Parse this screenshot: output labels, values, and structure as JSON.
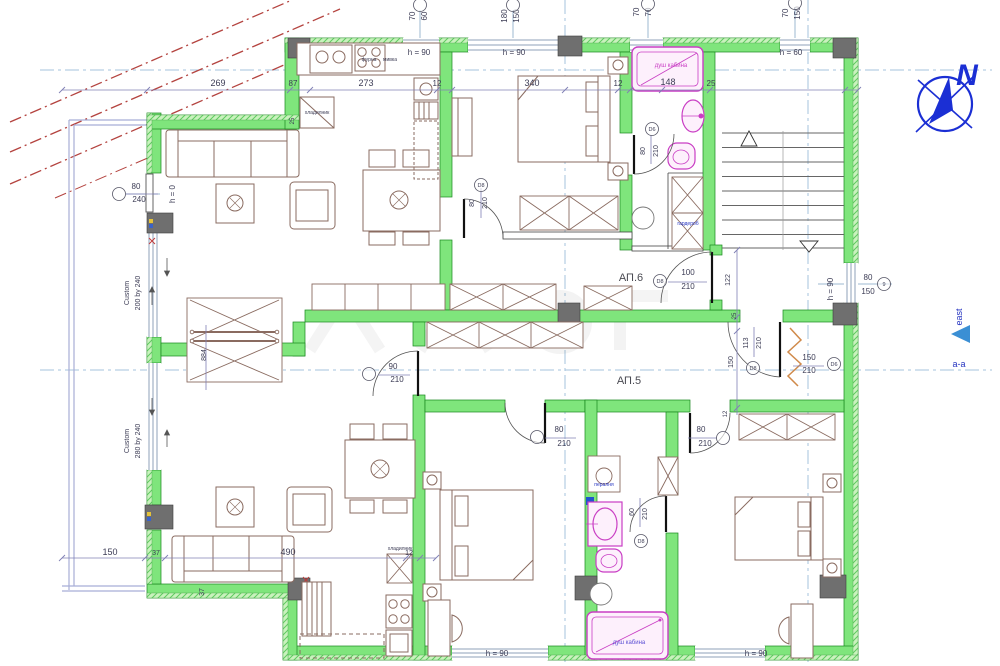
{
  "drawing": {
    "type": "architectural-floor-plan",
    "apartments": [
      {
        "id": "АП.6"
      },
      {
        "id": "АП.5"
      }
    ],
    "door_types": [
      "D6",
      "D8"
    ],
    "compass": {
      "north_letter": "N",
      "east_label": "east",
      "section_label": "а-а"
    },
    "colors": {
      "dim": "#3c3c55",
      "dim2": "#4a4a52",
      "blue": "#2433c0",
      "navy": "#1b2fd4",
      "pink": "#c93ec4",
      "violet": "#5b4fd4",
      "wall": "#7fe57c",
      "wallEdge": "#18871d",
      "column": "#6f6f6f",
      "furniture": "#8a6b60",
      "redline": "#b4433f",
      "axis": "#a6c3dc",
      "dimline": "#8080b5",
      "balcony": "#a8aed6",
      "orange": "#d08a4a",
      "eastTriangle": "#3b8fd4"
    },
    "labels": [
      {
        "t": "70",
        "x": 415,
        "y": 16,
        "r": -90,
        "s": 8
      },
      {
        "t": "60",
        "x": 427,
        "y": 16,
        "r": -90,
        "s": 8
      },
      {
        "t": "180",
        "x": 507,
        "y": 16,
        "r": -90,
        "s": 8
      },
      {
        "t": "150",
        "x": 519,
        "y": 16,
        "r": -90,
        "s": 8
      },
      {
        "t": "70",
        "x": 639,
        "y": 12,
        "r": -90,
        "s": 8
      },
      {
        "t": "70",
        "x": 651,
        "y": 12,
        "r": -90,
        "s": 8
      },
      {
        "t": "70",
        "x": 788,
        "y": 13,
        "r": -90,
        "s": 8
      },
      {
        "t": "150",
        "x": 800,
        "y": 13,
        "r": -90,
        "s": 8
      },
      {
        "t": "269",
        "x": 218,
        "y": 86,
        "s": 9
      },
      {
        "t": "87",
        "x": 293,
        "y": 86,
        "s": 8
      },
      {
        "t": "273",
        "x": 366,
        "y": 86,
        "s": 9
      },
      {
        "t": "12",
        "x": 437,
        "y": 86,
        "s": 8
      },
      {
        "t": "340",
        "x": 532,
        "y": 86,
        "s": 9
      },
      {
        "t": "12",
        "x": 618,
        "y": 86,
        "s": 8
      },
      {
        "t": "148",
        "x": 668,
        "y": 85,
        "s": 9
      },
      {
        "t": "25",
        "x": 711,
        "y": 86,
        "s": 8
      },
      {
        "t": "h = 90",
        "x": 419,
        "y": 55,
        "s": 8
      },
      {
        "t": "h = 90",
        "x": 514,
        "y": 55,
        "s": 8
      },
      {
        "t": "h = 60",
        "x": 791,
        "y": 55,
        "s": 8
      },
      {
        "t": "h = 90",
        "x": 497,
        "y": 656,
        "s": 8
      },
      {
        "t": "h = 90",
        "x": 756,
        "y": 656,
        "s": 8
      },
      {
        "t": "h = 0",
        "x": 175,
        "y": 194,
        "r": -90,
        "s": 8
      },
      {
        "t": "h = 90",
        "x": 833,
        "y": 289,
        "r": -90,
        "s": 8
      },
      {
        "t": "80",
        "x": 136,
        "y": 189,
        "s": 8
      },
      {
        "t": "240",
        "x": 139,
        "y": 202,
        "s": 8
      },
      {
        "t": "Custom",
        "x": 129,
        "y": 293,
        "r": -90,
        "s": 7
      },
      {
        "t": "200 by 240",
        "x": 140,
        "y": 293,
        "r": -90,
        "s": 7
      },
      {
        "t": "Custom",
        "x": 129,
        "y": 441,
        "r": -90,
        "s": 7
      },
      {
        "t": "280 by 240",
        "x": 140,
        "y": 441,
        "r": -90,
        "s": 7
      },
      {
        "t": "884",
        "x": 206,
        "y": 355,
        "r": -90,
        "s": 7
      },
      {
        "t": "37",
        "x": 204,
        "y": 592,
        "r": -90,
        "s": 7
      },
      {
        "t": "150",
        "x": 110,
        "y": 555,
        "s": 9
      },
      {
        "t": "37",
        "x": 156,
        "y": 555,
        "s": 7
      },
      {
        "t": "490",
        "x": 288,
        "y": 555,
        "s": 9
      },
      {
        "t": "12",
        "x": 409,
        "y": 555,
        "s": 7
      },
      {
        "t": "80",
        "x": 868,
        "y": 280,
        "s": 8
      },
      {
        "t": "150",
        "x": 868,
        "y": 294,
        "s": 8
      },
      {
        "t": "АП.6",
        "x": 631,
        "y": 281,
        "s": 11,
        "c": "dim2",
        "n": "apartment-6-label"
      },
      {
        "t": "АП.5",
        "x": 629,
        "y": 384,
        "s": 11,
        "c": "dim2",
        "n": "apartment-5-label"
      },
      {
        "t": "80",
        "x": 474,
        "y": 203,
        "r": -90,
        "s": 7
      },
      {
        "t": "210",
        "x": 487,
        "y": 203,
        "r": -90,
        "s": 7
      },
      {
        "t": "80",
        "x": 645,
        "y": 151,
        "r": -90,
        "s": 7
      },
      {
        "t": "210",
        "x": 658,
        "y": 151,
        "r": -90,
        "s": 7
      },
      {
        "t": "100",
        "x": 688,
        "y": 275,
        "s": 8
      },
      {
        "t": "210",
        "x": 688,
        "y": 289,
        "s": 8
      },
      {
        "t": "90",
        "x": 393,
        "y": 369,
        "s": 8
      },
      {
        "t": "210",
        "x": 397,
        "y": 382,
        "s": 8
      },
      {
        "t": "80",
        "x": 559,
        "y": 432,
        "s": 8
      },
      {
        "t": "210",
        "x": 564,
        "y": 446,
        "s": 8
      },
      {
        "t": "80",
        "x": 701,
        "y": 432,
        "s": 8
      },
      {
        "t": "210",
        "x": 705,
        "y": 446,
        "s": 8
      },
      {
        "t": "60",
        "x": 634,
        "y": 512,
        "r": -90,
        "s": 7
      },
      {
        "t": "210",
        "x": 647,
        "y": 514,
        "r": -90,
        "s": 7
      },
      {
        "t": "113",
        "x": 748,
        "y": 343,
        "r": -90,
        "s": 7
      },
      {
        "t": "210",
        "x": 761,
        "y": 343,
        "r": -90,
        "s": 7
      },
      {
        "t": "122",
        "x": 730,
        "y": 280,
        "r": -90,
        "s": 7
      },
      {
        "t": "25",
        "x": 736,
        "y": 316,
        "r": -90,
        "s": 6
      },
      {
        "t": "150",
        "x": 733,
        "y": 362,
        "r": -90,
        "s": 7
      },
      {
        "t": "12",
        "x": 727,
        "y": 414,
        "r": -90,
        "s": 6
      },
      {
        "t": "25",
        "x": 294,
        "y": 121,
        "r": -90,
        "s": 6
      },
      {
        "t": "150",
        "x": 809,
        "y": 360,
        "s": 8
      },
      {
        "t": "210",
        "x": 809,
        "y": 373,
        "s": 8
      },
      {
        "t": "душ кабина",
        "x": 671,
        "y": 67,
        "s": 6,
        "c": "pink",
        "n": "shower-cabin-label"
      },
      {
        "t": "душ кабина",
        "x": 629,
        "y": 644,
        "s": 6,
        "c": "violet",
        "n": "shower-cabin-label"
      },
      {
        "t": "гардероб",
        "x": 688,
        "y": 225,
        "s": 5,
        "c": "blue",
        "n": "wardrobe-label"
      },
      {
        "t": "пералня",
        "x": 604,
        "y": 486,
        "s": 5,
        "c": "blue",
        "n": "washing-machine-label"
      },
      {
        "t": "хладилник",
        "x": 317,
        "y": 114,
        "s": 5,
        "n": "fridge-label"
      },
      {
        "t": "хладилник",
        "x": 400,
        "y": 550,
        "s": 5,
        "n": "fridge-label"
      },
      {
        "t": "фурна",
        "x": 369,
        "y": 61,
        "s": 5,
        "n": "oven-label"
      },
      {
        "t": "мивка",
        "x": 390,
        "y": 61,
        "s": 5,
        "n": "sink-label"
      },
      {
        "t": "east",
        "x": 962,
        "y": 317,
        "r": -90,
        "s": 9,
        "c": "blue",
        "n": "east-label"
      },
      {
        "t": "а-а",
        "x": 959,
        "y": 367,
        "s": 9,
        "c": "blue",
        "n": "section-label"
      },
      {
        "t": "N",
        "x": 967,
        "y": 85,
        "s": 30,
        "c": "navy",
        "i": 1,
        "n": "north-letter"
      }
    ],
    "bubbles": [
      {
        "x": 420,
        "y": 5
      },
      {
        "x": 513,
        "y": 5
      },
      {
        "x": 648,
        "y": 4
      },
      {
        "x": 795,
        "y": 3
      },
      {
        "x": 119,
        "y": 194
      },
      {
        "x": 884,
        "y": 284,
        "t": "9"
      },
      {
        "x": 481,
        "y": 185,
        "t": "D8"
      },
      {
        "x": 652,
        "y": 129,
        "t": "D6"
      },
      {
        "x": 660,
        "y": 281,
        "t": "D8"
      },
      {
        "x": 369,
        "y": 374
      },
      {
        "x": 537,
        "y": 437
      },
      {
        "x": 723,
        "y": 438
      },
      {
        "x": 641,
        "y": 541,
        "t": "D8"
      },
      {
        "x": 753,
        "y": 368,
        "t": "D8"
      },
      {
        "x": 834,
        "y": 364,
        "t": "D6"
      }
    ]
  }
}
